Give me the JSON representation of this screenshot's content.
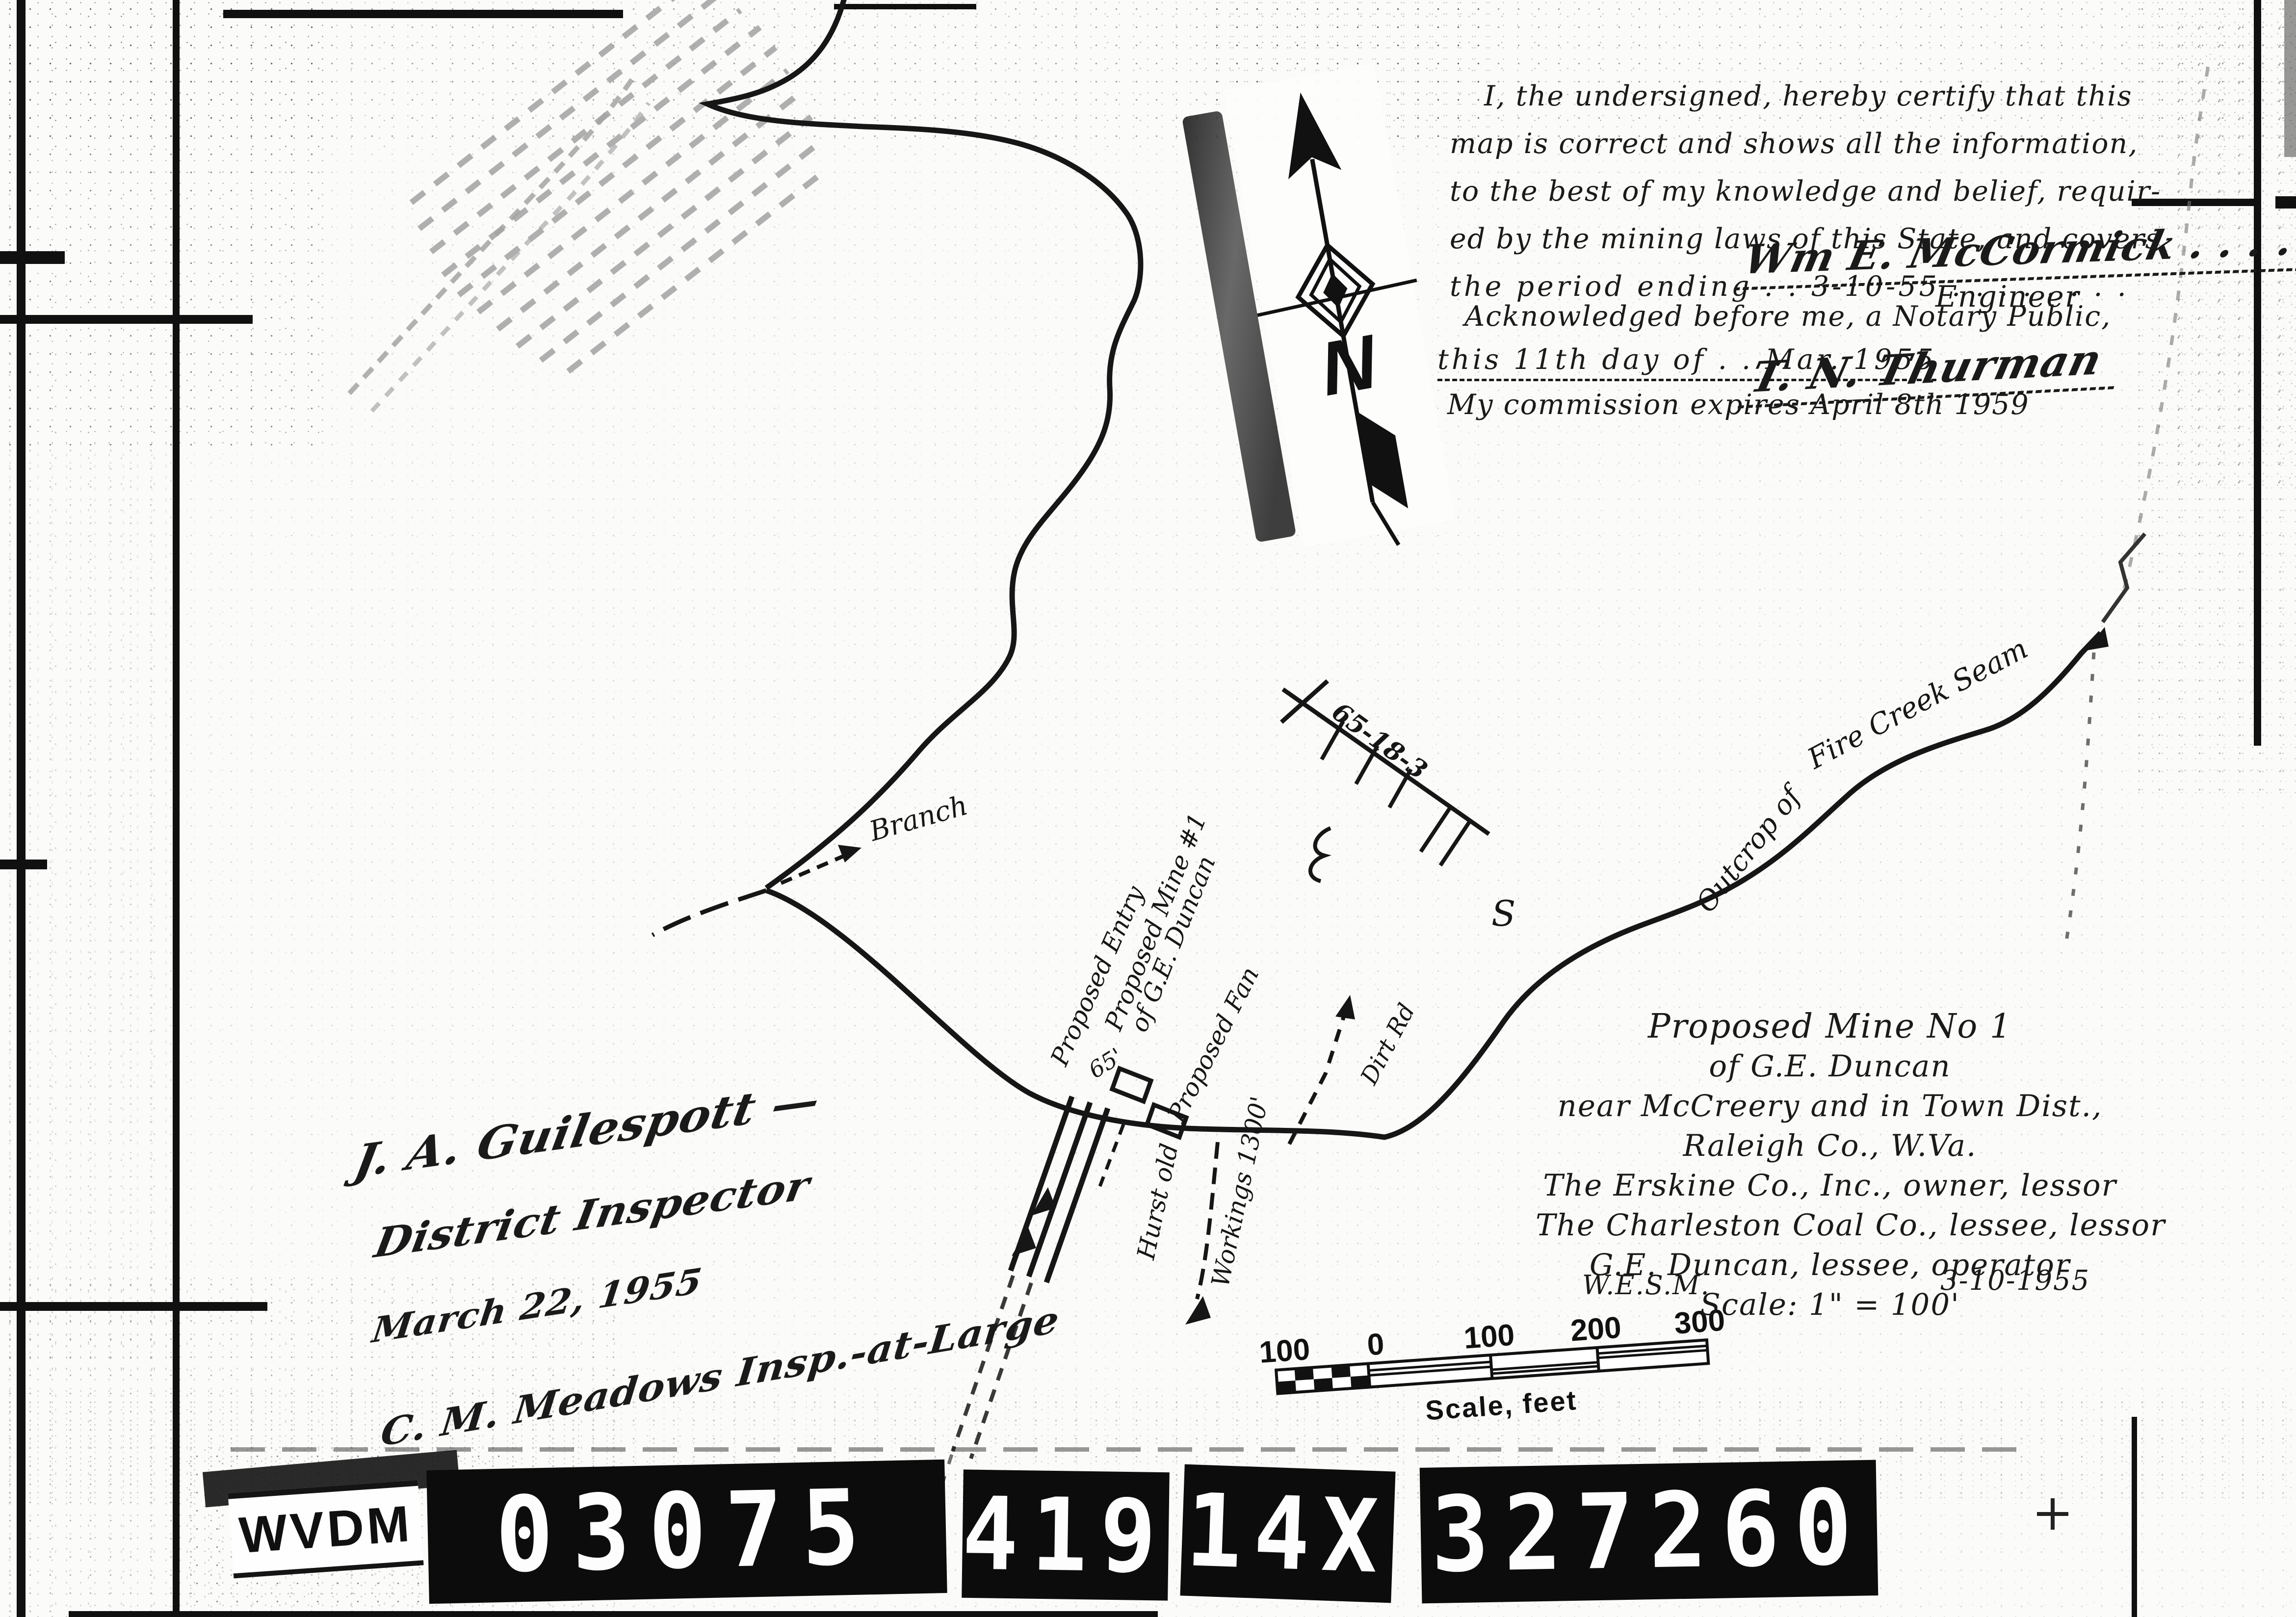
{
  "certification": {
    "line1": "I, the undersigned, hereby certify that this",
    "line2": "map is correct and shows all the information,",
    "line3": "to the best of my knowledge and belief, requir-",
    "line4": "ed by the mining laws of this State, and covers",
    "line5": "the period ending . . 3-10-55 . . . . . . . .",
    "engineer_signature": "Wm E. McCormick . . . .",
    "engineer_title": "Engineer",
    "ack_line1": "Acknowledged before me, a Notary Public,",
    "ack_line2": "this 11th day of . . Mar. 1955",
    "notary_signature": "T. N. Thurman",
    "commission_line": "My commission expires April 8th 1959"
  },
  "title_block": {
    "line1": "Proposed Mine No 1",
    "line2": "of G.E. Duncan",
    "line3": "near McCreery and in Town Dist.,",
    "line4": "Raleigh Co., W.Va.",
    "line5": "The Erskine Co., Inc., owner, lessor",
    "line6": "The Charleston Coal Co., lessee, lessor",
    "line7": "G.E. Duncan, lessee, operator",
    "line8": "Scale: 1\" = 100'",
    "footer_left": "W.E.S.M.",
    "footer_right": "3-10-1955"
  },
  "inspector_block": {
    "line1": "J. A. Guilespott —",
    "line2": "District Inspector",
    "line3": "March 22, 1955",
    "line4": "C. M. Meadows Insp.-at-Large"
  },
  "map_labels": {
    "branch": "Branch",
    "proposed_entry": "Proposed Entry",
    "proposed_mine": "Proposed Mine #1",
    "of_duncan": "of G.E. Duncan",
    "entry_width": "65'",
    "proposed_fan": "Proposed Fan",
    "old_workings_1": "Hurst old",
    "old_workings_2": "Workings 1300'",
    "dirt_road": "Dirt Rd",
    "outcrop_1": "Outcrop of",
    "outcrop_2": "Fire Creek Seam",
    "survey_note": "65-18-3",
    "s_mark": "S",
    "compass_n": "N"
  },
  "scale_bar": {
    "ticks": [
      "100",
      "0",
      "100",
      "200",
      "300"
    ],
    "caption": "Scale, feet"
  },
  "id_plates": {
    "agency": "WVDM",
    "numbers": [
      "03075",
      "419",
      "14X",
      "327260"
    ]
  }
}
